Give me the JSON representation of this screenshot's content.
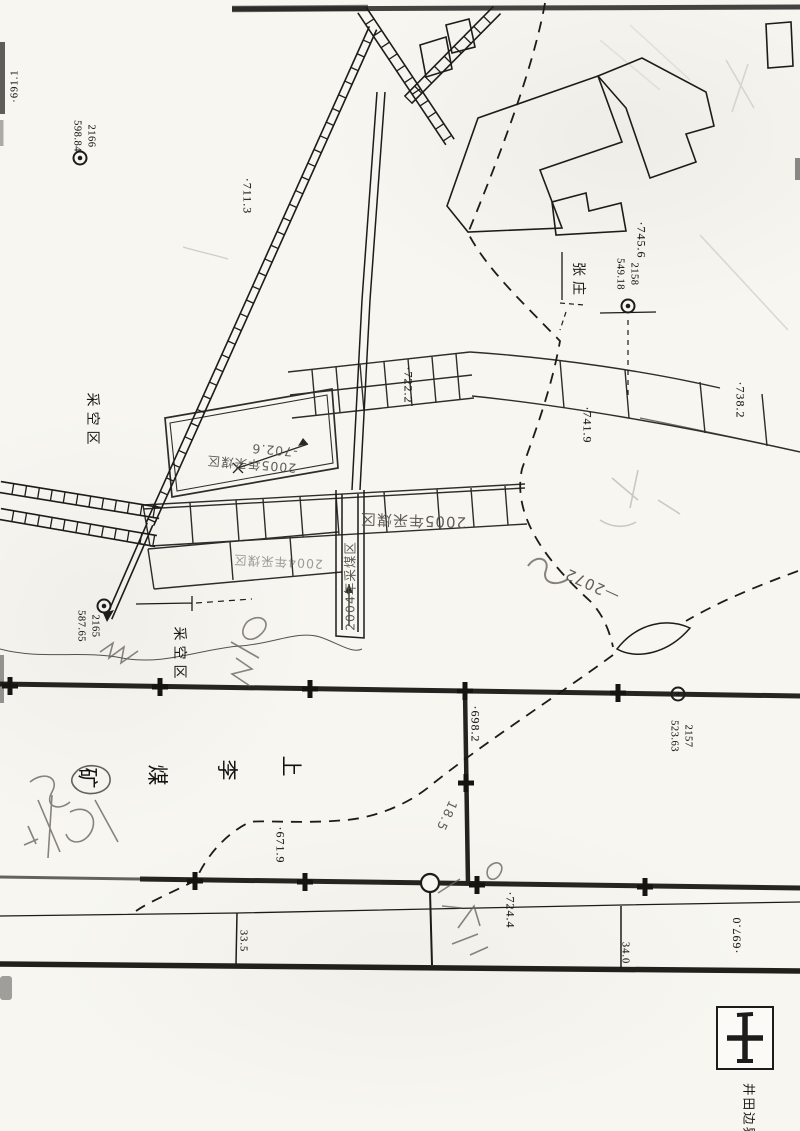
{
  "page": {
    "type": "scanned coal-mine plan map",
    "width": 800,
    "height": 1131
  },
  "colors": {
    "ink": "#1d1c1a",
    "pencil": "#6a675f",
    "paper": "#f7f6f1"
  },
  "map_labels": [
    {
      "id": "elev-691-1",
      "cls": "print sm",
      "text": "·691.1",
      "x": 15,
      "y": 86,
      "rot": -90
    },
    {
      "id": "survey-label-2166",
      "cls": "survey",
      "lines": [
        "2166",
        "598.84"
      ],
      "x": 84,
      "y": 136,
      "rot": 90
    },
    {
      "id": "elev-711-3",
      "cls": "print",
      "text": "·711.3",
      "x": 247,
      "y": 196,
      "rot": 90
    },
    {
      "id": "elev-722-2",
      "cls": "print",
      "text": "·722.2",
      "x": 408,
      "y": 385,
      "rot": 90
    },
    {
      "id": "elev-745-6",
      "cls": "print",
      "text": "·745.6",
      "x": 641,
      "y": 240,
      "rot": 90
    },
    {
      "id": "survey-label-2158",
      "cls": "survey",
      "lines": [
        "2158",
        "549.18"
      ],
      "x": 627,
      "y": 274,
      "rot": 90
    },
    {
      "id": "place-zhangzhuang",
      "cls": "cjk",
      "text": "张庄",
      "x": 579,
      "y": 281,
      "rot": 90
    },
    {
      "id": "elev-738-2",
      "cls": "print",
      "text": "·738.2",
      "x": 740,
      "y": 400,
      "rot": 90
    },
    {
      "id": "elev-741-9",
      "cls": "print",
      "text": "·741.9",
      "x": 587,
      "y": 425,
      "rot": 90
    },
    {
      "id": "goaf-area-1",
      "cls": "cjk",
      "text": "采空区",
      "x": 93,
      "y": 421,
      "rot": 90
    },
    {
      "id": "survey-label-2165",
      "cls": "survey",
      "lines": [
        "2165",
        "587.65"
      ],
      "x": 88,
      "y": 626,
      "rot": 90
    },
    {
      "id": "goaf-area-2",
      "cls": "cjk",
      "text": "采空区",
      "x": 180,
      "y": 655,
      "rot": 90
    },
    {
      "id": "mine-name-shang",
      "cls": "name",
      "text": "上",
      "x": 292,
      "y": 766,
      "rot": 90
    },
    {
      "id": "mine-name-li",
      "cls": "name",
      "text": "李",
      "x": 228,
      "y": 770,
      "rot": 90
    },
    {
      "id": "mine-name-mei",
      "cls": "name",
      "text": "煤",
      "x": 158,
      "y": 775,
      "rot": 90
    },
    {
      "id": "mine-name-kuang",
      "cls": "name",
      "text": "矿",
      "x": 88,
      "y": 778,
      "rot": 90
    },
    {
      "id": "elev-698-2",
      "cls": "print",
      "text": "·698.2",
      "x": 475,
      "y": 724,
      "rot": 90
    },
    {
      "id": "survey-label-2157",
      "cls": "survey",
      "lines": [
        "2157",
        "523.63"
      ],
      "x": 681,
      "y": 736,
      "rot": 90
    },
    {
      "id": "elev-671-9",
      "cls": "print",
      "text": "·671.9",
      "x": 280,
      "y": 845,
      "rot": 90
    },
    {
      "id": "elev-724-4",
      "cls": "print",
      "text": "·724.4",
      "x": 510,
      "y": 910,
      "rot": 90
    },
    {
      "id": "road-width-33-5",
      "cls": "print sm",
      "text": "33.5",
      "x": 243,
      "y": 941,
      "rot": 90
    },
    {
      "id": "road-width-34-0",
      "cls": "print sm",
      "text": "34.0",
      "x": 625,
      "y": 953,
      "rot": 90
    },
    {
      "id": "elev-697-0",
      "cls": "print",
      "text": "·697.0",
      "x": 737,
      "y": 935,
      "rot": -90
    },
    {
      "id": "hw-2005-goaf-a",
      "cls": "hw",
      "lines": [
        "2005年采煤区",
        "-702.6"
      ],
      "x": 252,
      "y": 458,
      "rot": 185
    },
    {
      "id": "hw-2005-goaf-b",
      "cls": "hw lg",
      "text": "2005年采煤区",
      "x": 413,
      "y": 521,
      "rot": 182
    },
    {
      "id": "hw-2004-goaf-a",
      "cls": "hw faint",
      "text": "2004年采煤区",
      "x": 278,
      "y": 563,
      "rot": 183
    },
    {
      "id": "hw-2004-goaf-b",
      "cls": "hw",
      "text": "2004年采煤区",
      "x": 349,
      "y": 586,
      "rot": 270
    },
    {
      "id": "hw-2072",
      "cls": "hw lg",
      "text": "—2072",
      "x": 592,
      "y": 585,
      "rot": 205
    },
    {
      "id": "hw-18-5",
      "cls": "hw",
      "text": "18.5",
      "x": 447,
      "y": 816,
      "rot": 115
    }
  ],
  "survey_points": [
    {
      "number": "2166",
      "elevation": "598.84",
      "x": 80,
      "y": 158
    },
    {
      "number": "2158",
      "elevation": "549.18",
      "x": 628,
      "y": 306
    },
    {
      "number": "2165",
      "elevation": "587.65",
      "x": 104,
      "y": 606
    },
    {
      "number": "2157",
      "elevation": "523.63",
      "x": 678,
      "y": 694
    }
  ],
  "legend": {
    "symbol": "mine-field-boundary-cross",
    "label": "井田边界"
  }
}
